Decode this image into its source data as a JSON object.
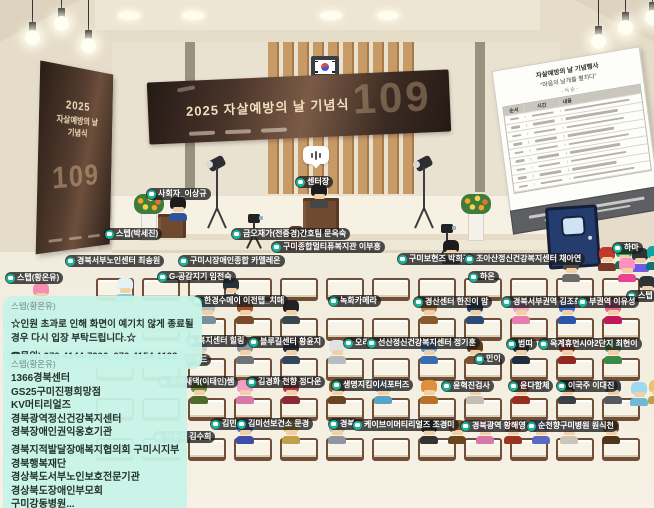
{
  "banner_main": {
    "title": "2025 자살예방의 날 기념식",
    "number": "109"
  },
  "banner_side": {
    "line1": "2025",
    "line2": "자살예방의 날",
    "line3": "기념식",
    "number": "109"
  },
  "schedule_board": {
    "title": "자살예방의 날 기념행사",
    "subtitle": "“마음의 날개를 펼치다”",
    "order_label": "- 식 순 -",
    "columns": [
      "순서",
      "시간",
      "내용"
    ],
    "row_count": 9
  },
  "chat_notices": [
    {
      "author": "스텝(황온유)",
      "lines": [
        "☆인원 초과로 인해 화면이 예기치 않게 종료될",
        "경우 다시 입장 부탁드립니다.☆",
        "☎문의) 070-4144-7906, 070-4154-1192"
      ]
    },
    {
      "author": "스텝(황온유)",
      "lines": [
        "1366경북센터",
        "GS25구미진평희망점",
        "KV머티리얼즈",
        "경북광역정신건강복지센터",
        "경북장애인권익옹호기관",
        "경북지적발달장애복지협의회 구미시지부",
        "경북행복재단",
        "경상북도서부노인보호전문기관",
        "경상북도장애인부모회",
        "구미강동병원..."
      ]
    }
  ],
  "nametags": [
    {
      "text": "사회자_이상규",
      "x": 146,
      "y": 188
    },
    {
      "text": "센터장",
      "x": 295,
      "y": 176
    },
    {
      "text": "스텝(박세진)",
      "x": 104,
      "y": 228
    },
    {
      "text": "금오재가(전중경)간호팀 문옥숙",
      "x": 231,
      "y": 228
    },
    {
      "text": "구미종합멀티퓨복지관 이부흥",
      "x": 271,
      "y": 241
    },
    {
      "text": "경북서부노인센터 최송원",
      "x": 65,
      "y": 255
    },
    {
      "text": "구미시장애인종합 카멜레온",
      "x": 178,
      "y": 255
    },
    {
      "text": "구미보현즈 박희경",
      "x": 397,
      "y": 253
    },
    {
      "text": "조아산정신건강복지센터 채아연",
      "x": 464,
      "y": 253
    },
    {
      "text": "하마",
      "x": 612,
      "y": 242
    },
    {
      "text": "스텝(황온유)",
      "x": 5,
      "y": 272
    },
    {
      "text": "G-공감지기 임전숙",
      "x": 157,
      "y": 271
    },
    {
      "text": "하온",
      "x": 468,
      "y": 271
    },
    {
      "text": "스텝",
      "x": 626,
      "y": 290
    },
    {
      "text": "한경수메이 이전탭_치매",
      "x": 192,
      "y": 295
    },
    {
      "text": "녹화카메라",
      "x": 328,
      "y": 295
    },
    {
      "text": "경산센터 한진이 맘",
      "x": 413,
      "y": 296
    },
    {
      "text": "경북서부권역 김조희",
      "x": 501,
      "y": 296
    },
    {
      "text": "부권역 이유성",
      "x": 577,
      "y": 296
    },
    {
      "text": "복지센터 힐링",
      "x": 186,
      "y": 335
    },
    {
      "text": "블루길센터 황윤지",
      "x": 248,
      "y": 336
    },
    {
      "text": "오리",
      "x": 343,
      "y": 337
    },
    {
      "text": "선산정신건강복지센터 정기훈",
      "x": 366,
      "y": 337
    },
    {
      "text": "범띠",
      "x": 506,
      "y": 338
    },
    {
      "text": "옥계휴먼시아2단지 최현이",
      "x": 538,
      "y": 338
    },
    {
      "text": "지오메드",
      "x": 166,
      "y": 354
    },
    {
      "text": "민이",
      "x": 474,
      "y": 353
    },
    {
      "text": "할미새댁(이태인)쌤",
      "x": 158,
      "y": 376
    },
    {
      "text": "김경화 천향 정다운",
      "x": 246,
      "y": 376
    },
    {
      "text": "생명지킴이서포터즈",
      "x": 331,
      "y": 379
    },
    {
      "text": "윤혁진검사",
      "x": 441,
      "y": 380
    },
    {
      "text": "윤다함체",
      "x": 508,
      "y": 380
    },
    {
      "text": "이국주 이대진",
      "x": 556,
      "y": 380
    },
    {
      "text": "김민",
      "x": 210,
      "y": 418
    },
    {
      "text": "김미선보건소 문경",
      "x": 236,
      "y": 418
    },
    {
      "text": "경북",
      "x": 328,
      "y": 418
    },
    {
      "text": "케이브이머티리얼즈 조경미",
      "x": 352,
      "y": 419
    },
    {
      "text": "경북광역 황해영",
      "x": 460,
      "y": 420
    },
    {
      "text": "순천향구미병원 원식천",
      "x": 526,
      "y": 420
    },
    {
      "text": "차윤미 김수희",
      "x": 153,
      "y": 431
    }
  ],
  "benches": {
    "rows": [
      278,
      318,
      358,
      398,
      438
    ],
    "x_start": 96,
    "spacing": 46,
    "count": 12
  },
  "avatars": [
    {
      "x": 167,
      "y": 197,
      "hair": "#1c1c1c",
      "body": "#31539b"
    },
    {
      "x": 308,
      "y": 184,
      "hair": "#1c1c1c",
      "body": "#454545"
    },
    {
      "x": 285,
      "y": 226,
      "hair": "#5d3b23",
      "body": "#b05a50"
    },
    {
      "x": 30,
      "y": 283,
      "hair": "#f48fb1",
      "body": "#ec407a"
    },
    {
      "x": 114,
      "y": 278,
      "hair": "#e3f2f7",
      "body": "#90c6da"
    },
    {
      "x": 220,
      "y": 278,
      "hair": "#263238",
      "body": "#50616d"
    },
    {
      "x": 596,
      "y": 247,
      "hair": "#c0392b",
      "body": "#79382c"
    },
    {
      "x": 613,
      "y": 245,
      "hair": "#2e9e5b",
      "body": "#1f6e43"
    },
    {
      "x": 629,
      "y": 248,
      "hair": "#2d3436",
      "body": "#6c5ce7"
    },
    {
      "x": 644,
      "y": 246,
      "hair": "#10a3a3",
      "body": "#0c7474"
    },
    {
      "x": 616,
      "y": 258,
      "hair": "#ff8fc0",
      "body": "#e84393"
    },
    {
      "x": 636,
      "y": 276,
      "hair": "#2d3436",
      "body": "#9aa5ab"
    },
    {
      "x": 440,
      "y": 240,
      "hair": "#1c1c1c",
      "body": "#37474f"
    },
    {
      "x": 560,
      "y": 258,
      "hair": "#4a4a4a",
      "body": "#6b6b6b"
    },
    {
      "x": 196,
      "y": 300,
      "hair": "#b0bec5",
      "body": "#78909c"
    },
    {
      "x": 234,
      "y": 300,
      "hair": "#a0522d",
      "body": "#7a4a2a"
    },
    {
      "x": 280,
      "y": 300,
      "hair": "#212121",
      "body": "#37474f"
    },
    {
      "x": 418,
      "y": 300,
      "hair": "#b5824c",
      "body": "#8a5a2b"
    },
    {
      "x": 464,
      "y": 300,
      "hair": "#203a5c",
      "body": "#2c4a74"
    },
    {
      "x": 510,
      "y": 300,
      "hair": "#f5a3c7",
      "body": "#e87bb0"
    },
    {
      "x": 556,
      "y": 300,
      "hair": "#3b6fd4",
      "body": "#2a55a8"
    },
    {
      "x": 602,
      "y": 300,
      "hair": "#f06292",
      "body": "#c2185b"
    },
    {
      "x": 188,
      "y": 340,
      "hair": "#c5c9cc",
      "body": "#9aa0a6"
    },
    {
      "x": 234,
      "y": 340,
      "hair": "#8d9399",
      "body": "#6d7378"
    },
    {
      "x": 280,
      "y": 340,
      "hair": "#1f2e3d",
      "body": "#31465c"
    },
    {
      "x": 326,
      "y": 340,
      "hair": "#dfe3e6",
      "body": "#b6bcc2"
    },
    {
      "x": 418,
      "y": 340,
      "hair": "#5290d8",
      "body": "#3a6cb0"
    },
    {
      "x": 464,
      "y": 340,
      "hair": "#5d3a1a",
      "body": "#7a5230"
    },
    {
      "x": 510,
      "y": 340,
      "hair": "#2c3e50",
      "body": "#1f2d3d"
    },
    {
      "x": 556,
      "y": 340,
      "hair": "#bf3a2e",
      "body": "#8e2a20"
    },
    {
      "x": 602,
      "y": 340,
      "hair": "#58b368",
      "body": "#3a8a4a"
    },
    {
      "x": 188,
      "y": 380,
      "hair": "#6d8f3c",
      "body": "#4f6b2a"
    },
    {
      "x": 234,
      "y": 380,
      "hair": "#f29fc5",
      "body": "#d877a8"
    },
    {
      "x": 280,
      "y": 380,
      "hair": "#b03a48",
      "body": "#8a2a36"
    },
    {
      "x": 326,
      "y": 380,
      "hair": "#8a5a2b",
      "body": "#6b451f"
    },
    {
      "x": 372,
      "y": 380,
      "hair": "#7ec3e6",
      "body": "#58a3c8"
    },
    {
      "x": 418,
      "y": 380,
      "hair": "#e0903a",
      "body": "#b87328"
    },
    {
      "x": 464,
      "y": 380,
      "hair": "#e8e4da",
      "body": "#c4beb0"
    },
    {
      "x": 510,
      "y": 380,
      "hair": "#c23b2e",
      "body": "#962c22"
    },
    {
      "x": 556,
      "y": 380,
      "hair": "#23262b",
      "body": "#3c4046"
    },
    {
      "x": 602,
      "y": 380,
      "hair": "#3c3f46",
      "body": "#55585f"
    },
    {
      "x": 628,
      "y": 382,
      "hair": "#9fd8f0",
      "body": "#6fb8d8"
    },
    {
      "x": 646,
      "y": 380,
      "hair": "#e7c56a",
      "body": "#c2a04a"
    },
    {
      "x": 234,
      "y": 420,
      "hair": "#5a6acf",
      "body": "#3f4da8"
    },
    {
      "x": 280,
      "y": 420,
      "hair": "#e7c56a",
      "body": "#c2a04a"
    },
    {
      "x": 326,
      "y": 420,
      "hair": "#b9bfc6",
      "body": "#8f969e"
    },
    {
      "x": 418,
      "y": 420,
      "hair": "#1b1b1b",
      "body": "#333333"
    },
    {
      "x": 446,
      "y": 420,
      "hair": "#8a5a2b",
      "body": "#6b451f"
    },
    {
      "x": 474,
      "y": 420,
      "hair": "#f2a0c8",
      "body": "#d877a8"
    },
    {
      "x": 502,
      "y": 420,
      "hair": "#c8452e",
      "body": "#9a3322"
    },
    {
      "x": 530,
      "y": 420,
      "hair": "#7e8fe0",
      "body": "#5a6ac0"
    },
    {
      "x": 558,
      "y": 420,
      "hair": "#f5f2ee",
      "body": "#cac4ba"
    },
    {
      "x": 600,
      "y": 420,
      "hair": "#6b4a2a",
      "body": "#4f351c"
    }
  ],
  "icons": {
    "name_tag_icon": "chat-bubble",
    "speech_indicator": "sound-bars",
    "flag": "korean-flag"
  },
  "colors": {
    "tag_accent": "#14b89b",
    "chat_bg": "#c6f3e7",
    "banner_brown": "#4a342a",
    "wall": "#eae2d1",
    "floor": "#f4efe2",
    "wood_slat": "#c89a66"
  }
}
